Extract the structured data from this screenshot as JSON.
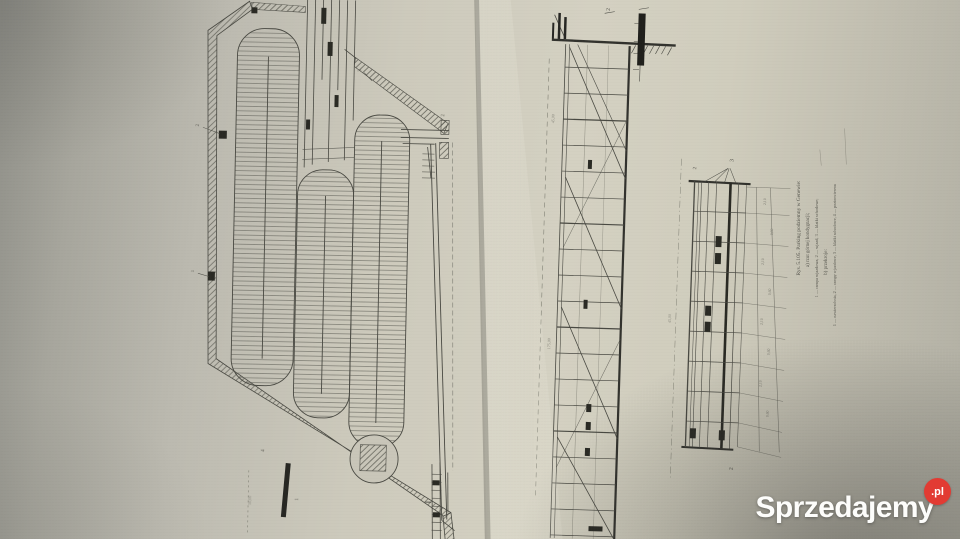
{
  "watermark": {
    "brand": "Sprzedajemy",
    "tld": ".pl",
    "badge_color": "#e23b33"
  },
  "figure": {
    "caption": {
      "line1": "Rys. 5.105. Parking podziemny w Genewie:",
      "line2": "a) rzut górnej kondygnacji;",
      "line3": "1 — rampa wjazdowa, 2 — wjazd, 3 — klatki schodowe;",
      "line4": "b) przekroje:",
      "line5": "1 — nawierzchnia, 2 — rampy wjazdowe, 3 — klatki schodowe, 4 — poziom terenu"
    },
    "plan_labels": [
      "2",
      "1",
      "3",
      "2",
      "1",
      "4"
    ],
    "section_marks": {
      "long_top": "2",
      "cross_top": "3",
      "cross_top_left": "2",
      "cross_bottom": "2"
    },
    "dims": [
      "2,10",
      "0,60",
      "2,10",
      "0,60",
      "2,10",
      "0,60",
      "2,10",
      "0,60"
    ],
    "dim_left_top": "45,00",
    "dim_left_bottom": "175,00",
    "dim_axis": "45,00",
    "dim_plan_left": "50,00"
  }
}
